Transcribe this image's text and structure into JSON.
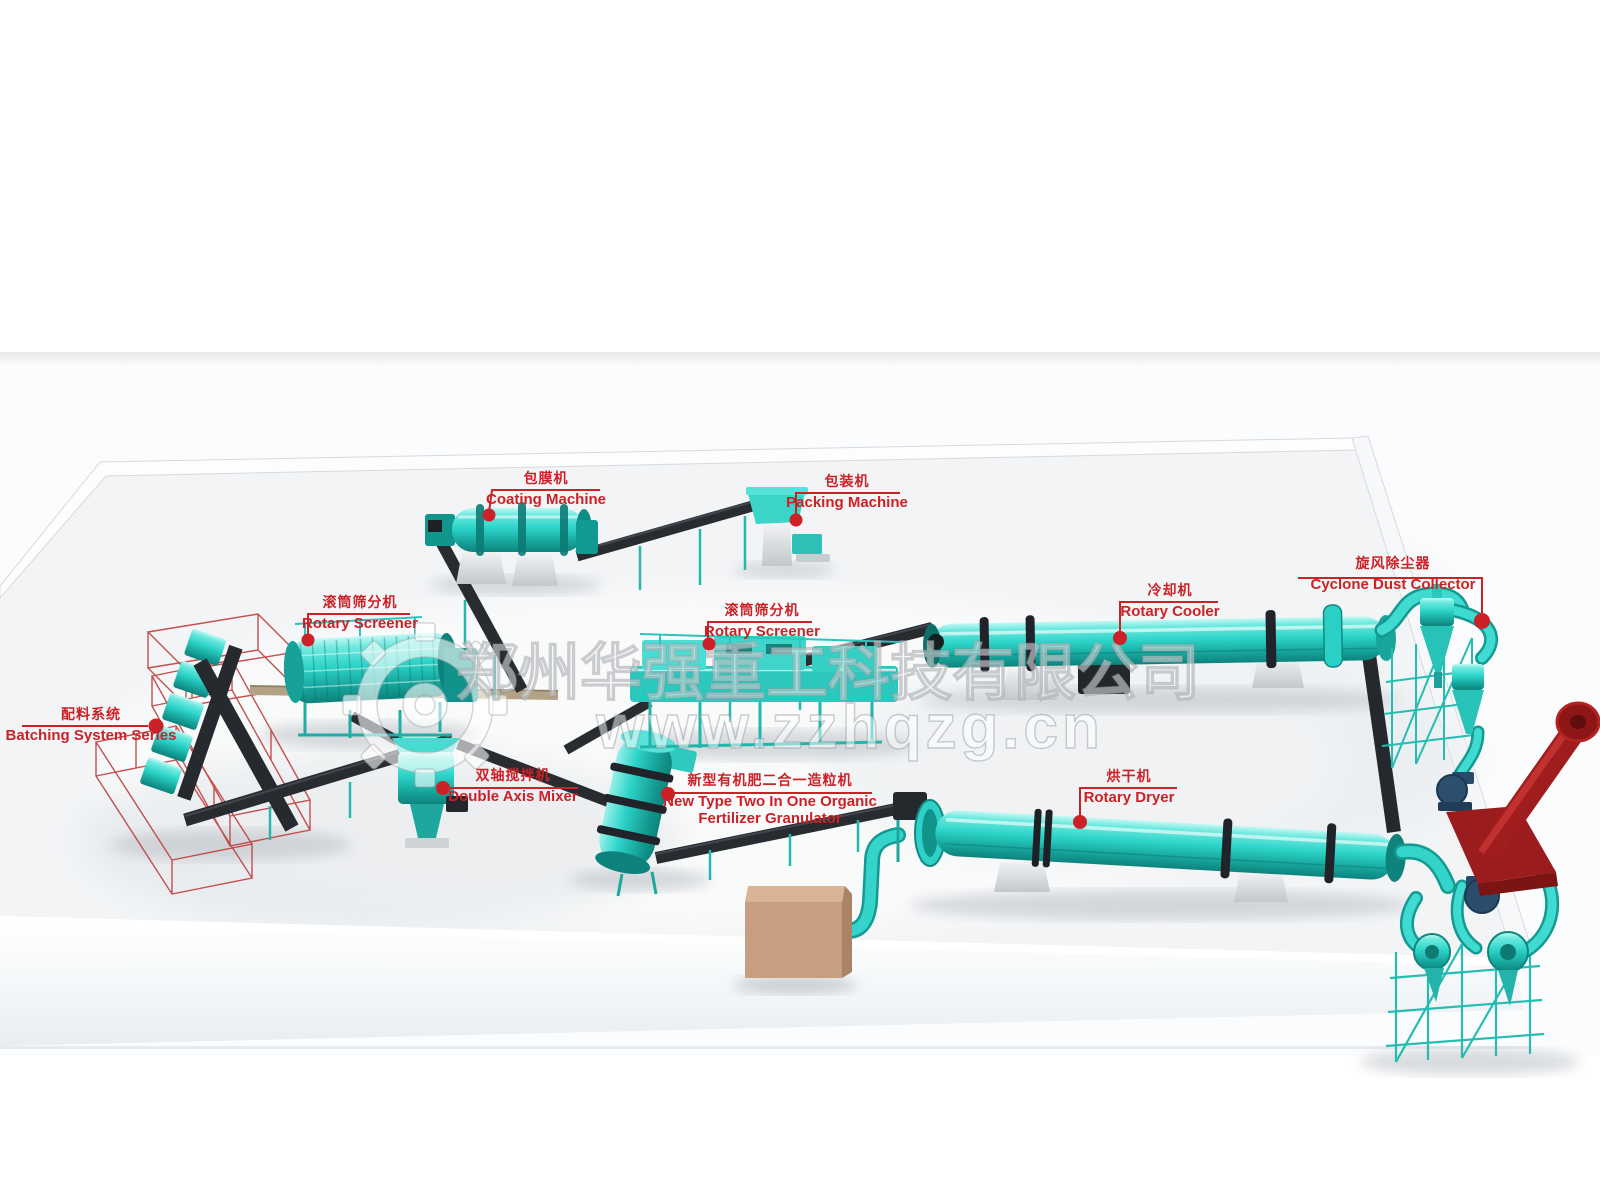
{
  "watermark": {
    "company": "郑州华强重工科技有限公司",
    "website": "www.zzhqzg.cn",
    "logo": "gear-icon"
  },
  "labels": {
    "coating": {
      "zh": "包膜机",
      "en": "Coating Machine"
    },
    "packing": {
      "zh": "包装机",
      "en": "Packing Machine"
    },
    "screener_left": {
      "zh": "滚筒筛分机",
      "en": "Rotary Screener"
    },
    "batching": {
      "zh": "配料系统",
      "en": "Batching System Series"
    },
    "mixer": {
      "zh": "双轴搅拌机",
      "en": "Double Axis Mixer"
    },
    "screener_center": {
      "zh": "滚筒筛分机",
      "en": "Rotary Screener"
    },
    "granulator": {
      "zh": "新型有机肥二合一造粒机",
      "en": "New Type Two In One Organic Fertilizer Granulator"
    },
    "cooler": {
      "zh": "冷却机",
      "en": "Rotary Cooler"
    },
    "dryer": {
      "zh": "烘干机",
      "en": "Rotary Dryer"
    },
    "cyclone": {
      "zh": "旋风除尘器",
      "en": "Cyclone Dust Collector"
    }
  },
  "colors": {
    "label_red": "#cc2127",
    "machine_cyan": "#2dd4c9",
    "machine_cyan_dark": "#0d837c",
    "conveyor_dark": "#282b30",
    "frame_red": "#c03d3d",
    "chimney_red": "#9b1c1c",
    "blower_navy": "#2c4f6e",
    "box_brown": "#c79e80",
    "belt_tan": "#b3a283",
    "floor_gray": "#f2f4f6"
  }
}
